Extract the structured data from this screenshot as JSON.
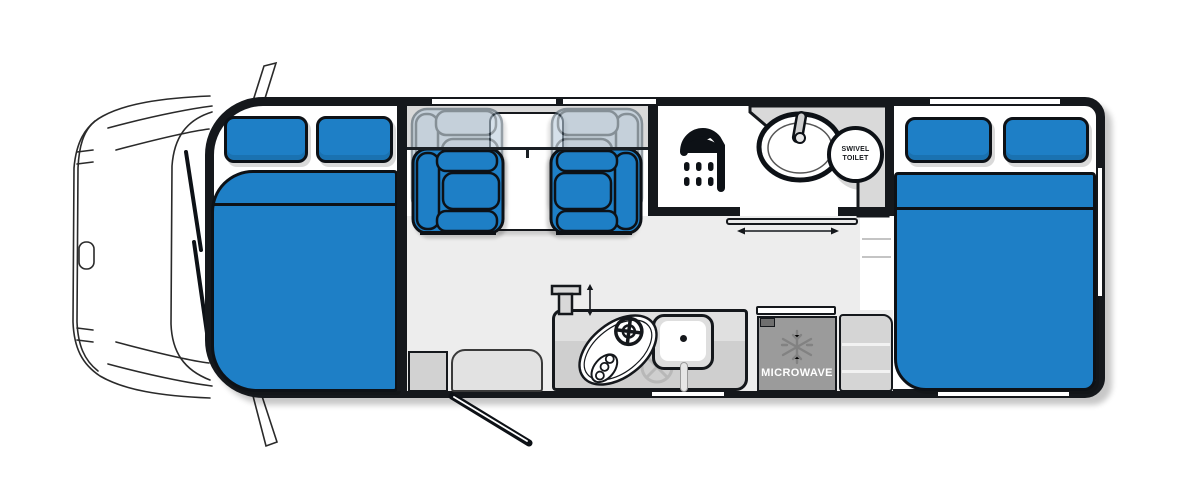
{
  "labels": {
    "toilet_line1": "SWIVEL",
    "toilet_line2": "TOILET",
    "microwave": "MICROWAVE"
  },
  "colors": {
    "background": "#ffffff",
    "wall_black": "#15181c",
    "furniture_blue": "#1e7fc6",
    "ghost_seat_blue": "#b7cbdb",
    "floor_gray": "#ededed",
    "counter_gray": "#d6d6d6",
    "appliance_gray": "#9b9b9b"
  },
  "icons": {
    "shower": "shower-icon",
    "snowflake": "snowflake-icon",
    "door_slide_arrow": "slide-arrow-icon",
    "tap_height_arrow": "tap-height-arrow-icon",
    "entry_door_swing": "door-swing-icon"
  }
}
